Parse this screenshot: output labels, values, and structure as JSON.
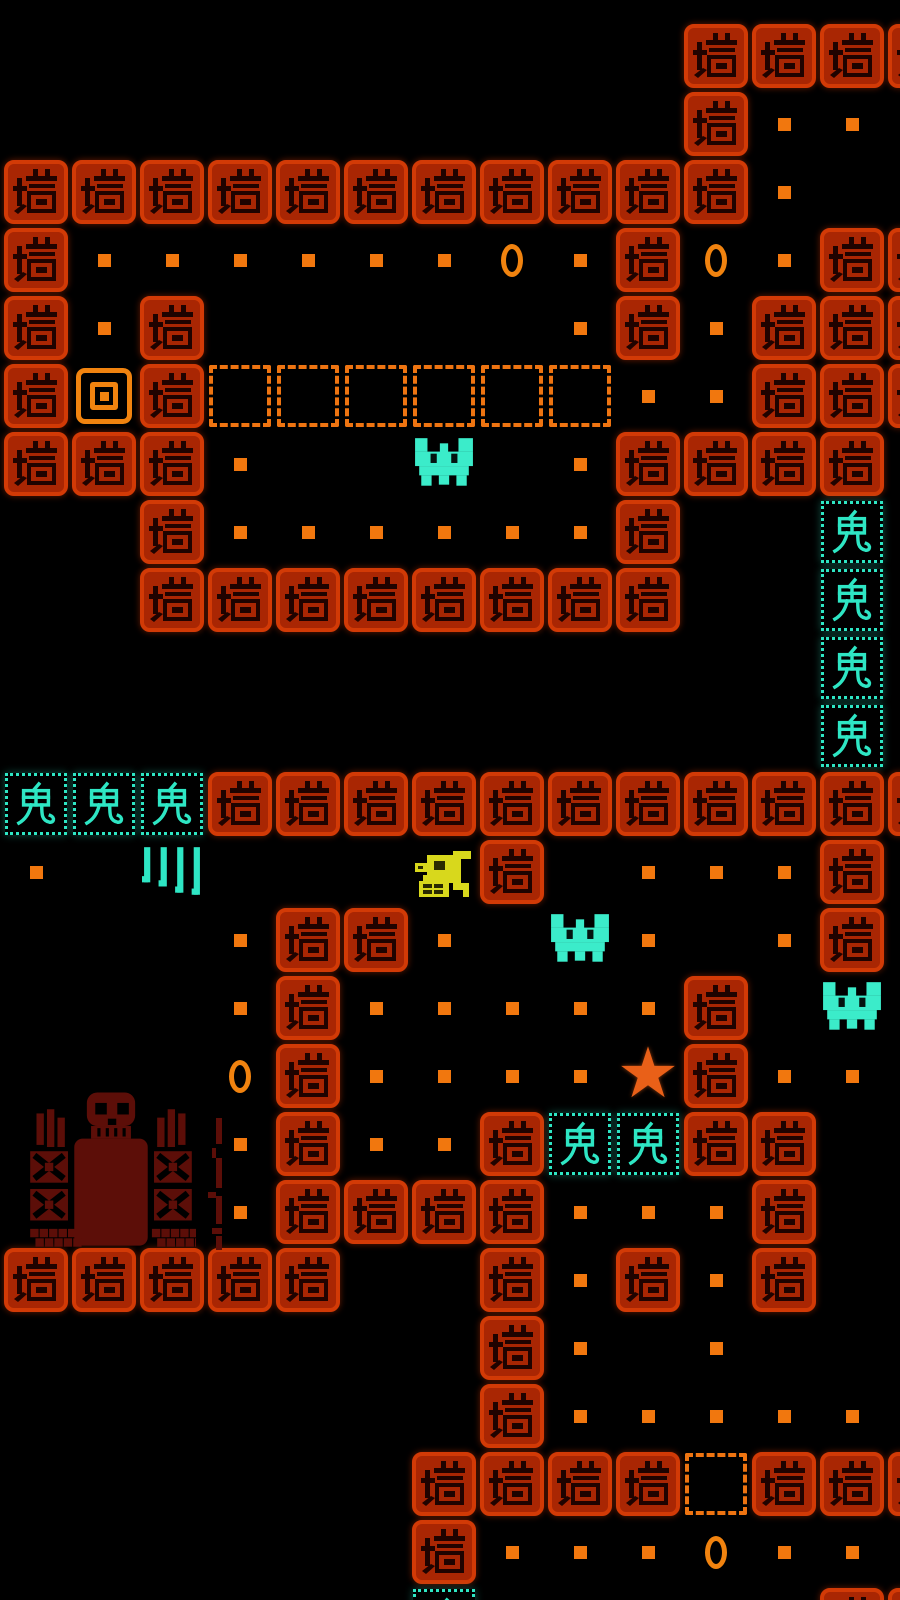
{
  "screen": {
    "width": 900,
    "height": 1600,
    "background": "#000000"
  },
  "board": {
    "cols": 14,
    "rows": 24,
    "cell_size": 68,
    "origin_x": 2,
    "origin_y": 22
  },
  "glyphs": {
    "wall_char": "墙",
    "ghost_char": "鬼",
    "star_char": "★"
  },
  "legend": {
    "#": "wall-tile",
    "g": "ghost-tile",
    ".": "pellet",
    "c": "coin",
    "d": "dashed-zone-cell",
    "T": "spawn-target",
    "B": "bat",
    "S": "star",
    "Y": "duck-creature",
    "K": "claw-marks",
    " ": "empty"
  },
  "map": [
    "          ####",
    "          #.. ",
    "###########.  ",
    "#......c.#c.##",
    "#.#     .#.###",
    "#T#dddddd..###",
    "###.  B .#### ",
    "  #......#  g ",
    "  ########  g ",
    "            g ",
    "            g ",
    "ggg###########",
    ". K   Y# ...# ",
    "   .##. B. .# ",
    "   .#.....# B ",
    "   c#....S#.. ",
    "   .#..#gg##  ",
    "   .####...#  ",
    "#####  #.#.#  ",
    "       #. .   ",
    "       #..... ",
    "      ####d###",
    "      #...c.. ",
    "      g     ##"
  ],
  "entities": [
    {
      "type": "gravestone",
      "x": 26,
      "y": 1084,
      "width": 170,
      "height": 168
    },
    {
      "type": "pillar-fragments",
      "x": 208,
      "y": 1118,
      "width": 26,
      "height": 132
    }
  ],
  "colors": {
    "background": "#000000",
    "wall_tile": "#a92603",
    "wall_tile_edge": "#d23a06",
    "wall_glyph": "#1f0300",
    "pellet": "#f1770e",
    "dashed_zone": "#ee7411",
    "coin": "#f1830f",
    "target": "#f1830f",
    "ghost": "#2ee6c4",
    "bat": "#3becca",
    "star": "#e96018",
    "duck": "#d8d81c",
    "duck_dark": "#2a2a00",
    "grave": "#5c0e08",
    "grave_dark": "#000000"
  }
}
